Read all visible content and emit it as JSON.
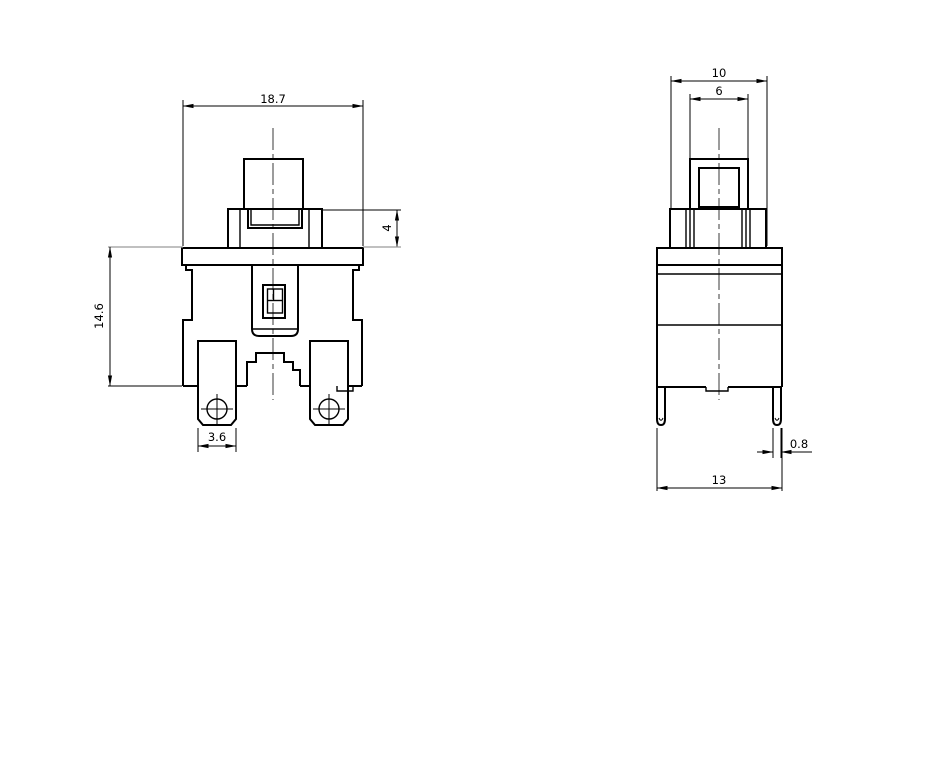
{
  "front_view": {
    "dims": {
      "width": "18.7",
      "bezel_height": "4",
      "height": "14.6",
      "terminal_width": "3.6"
    }
  },
  "side_view": {
    "dims": {
      "bezel_width": "10",
      "button_width": "6",
      "pin_width": "0.8",
      "width": "13"
    }
  },
  "colors": {
    "line": "#000000",
    "extension_gray": "#9b9b9b",
    "background": "#ffffff"
  }
}
